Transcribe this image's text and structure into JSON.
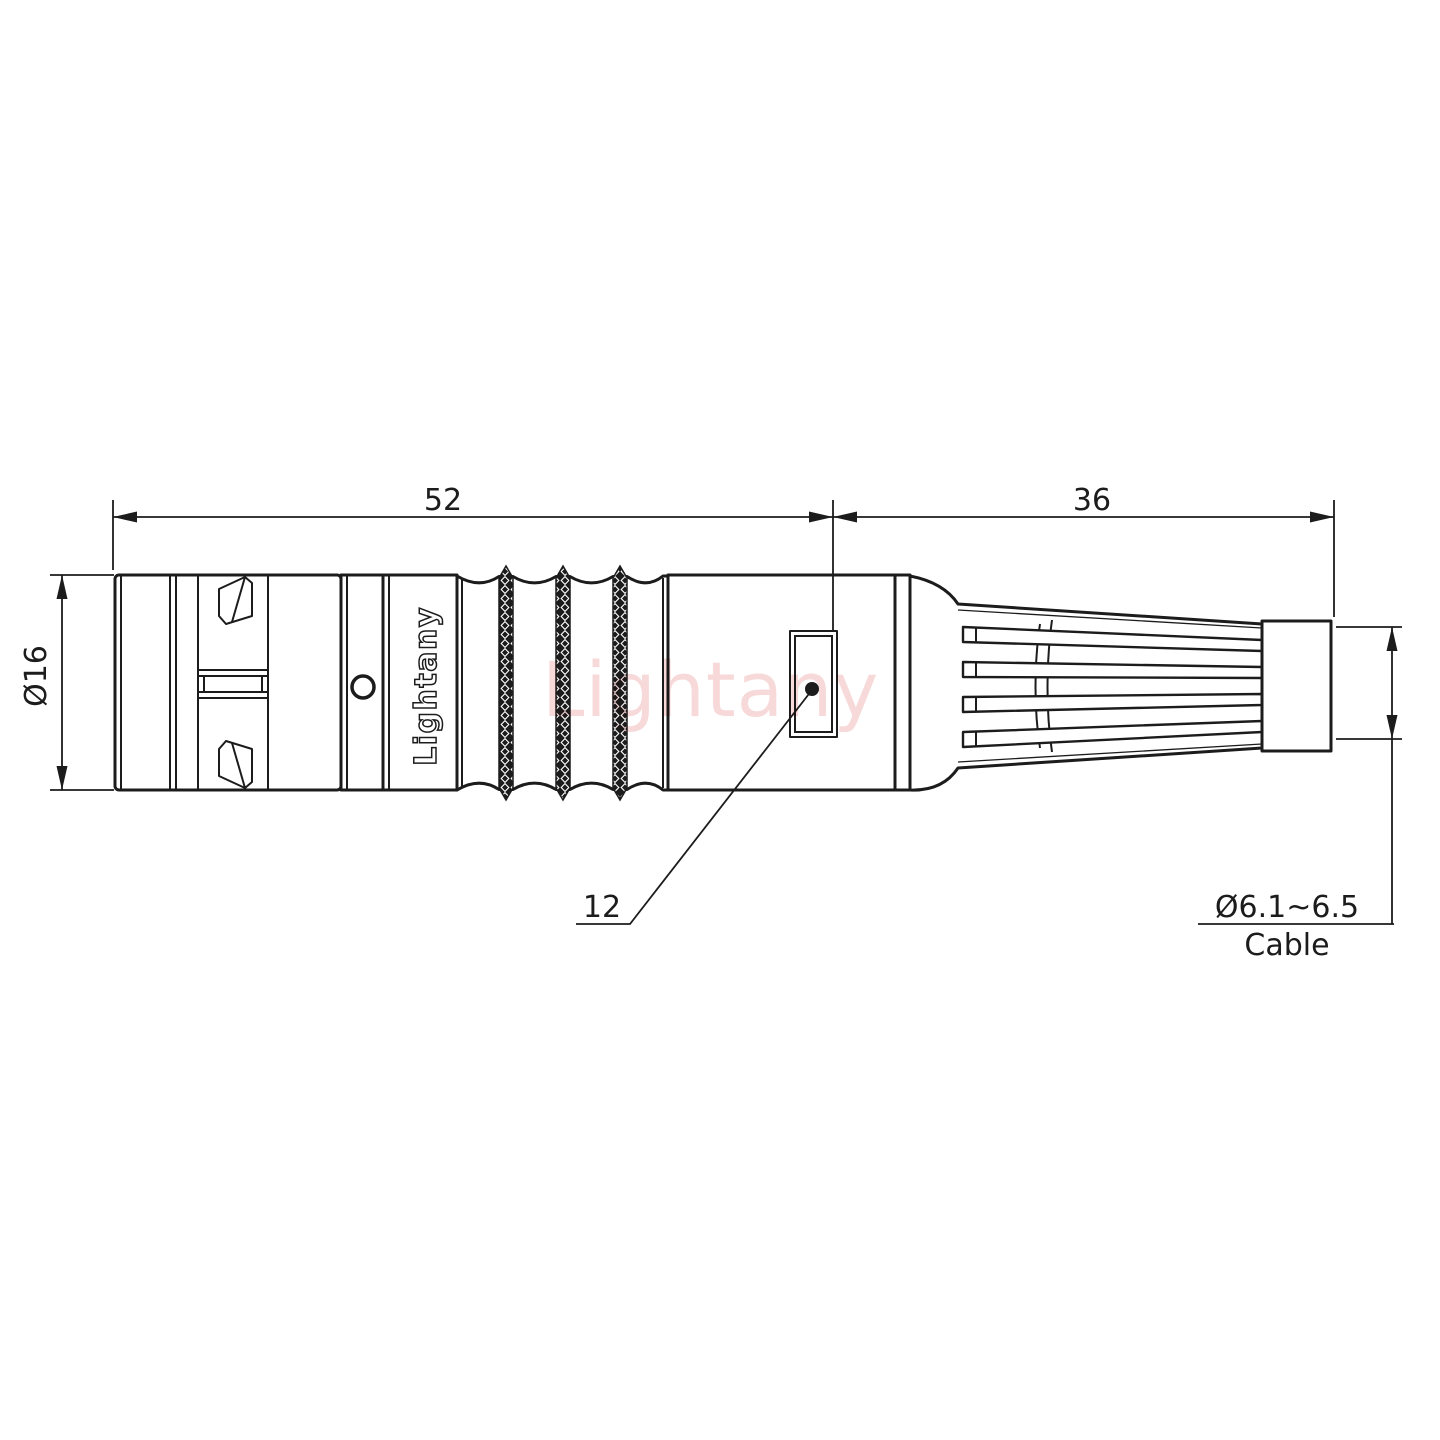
{
  "drawing": {
    "title_hint": "cable connector side-view technical drawing",
    "dimensions": {
      "front_length": "52",
      "rear_length": "36",
      "body_diameter": "Ø16",
      "window_size": "12",
      "cable_range": "Ø6.1~6.5",
      "cable_label": "Cable"
    },
    "branding": {
      "body_logo": "Lightany",
      "watermark": "Lightany"
    }
  },
  "colors": {
    "line": "#1c1c1c",
    "watermark": "#f0b4b4",
    "background": "#ffffff"
  }
}
